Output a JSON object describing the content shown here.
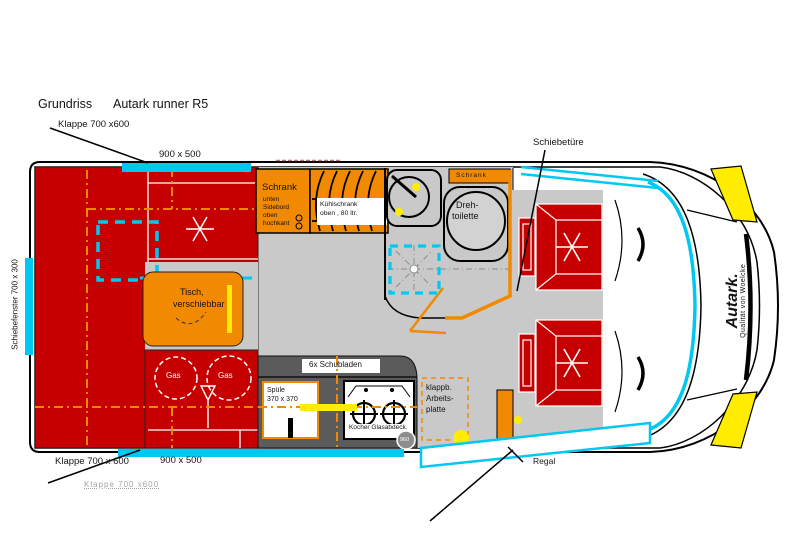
{
  "header": {
    "title": "Grundriss",
    "model": "Autark runner R5"
  },
  "exterior": {
    "top_hatch": "Klappe 700 x600",
    "top_window": "900 x 500",
    "side_window": "Schiebefenster 700 x 300",
    "sliding_door": "Schiebetüre",
    "bottom_hatch": "Klappe 700 x 600",
    "bottom_window": "900 x 500",
    "bottom_hatch_ghost": "Klappe 700 x600",
    "brand": "Autark.",
    "brand_sub": "Qualität von Woelcke"
  },
  "interior": {
    "wardrobe": {
      "line1": "Schrank",
      "line2": "unten",
      "line3": "Sidebord",
      "line4": "oben",
      "line5": "hochkant"
    },
    "fridge": {
      "line1": "Kühlschrank",
      "line2": "oben , 80 ltr."
    },
    "bath_cabinet": "Schrank",
    "toilet": {
      "line1": "Dreh-",
      "line2": "toilette"
    },
    "table": {
      "line1": "Tisch,",
      "line2": "verschiebbar"
    },
    "gas1": "Gas",
    "gas2": "Gas",
    "drawers": "6x Schubladen",
    "sink": {
      "line1": "Spüle",
      "line2": "370 x 370"
    },
    "cooker": "Kocher Glasabdeck.",
    "dim_circle": "960",
    "worktop": {
      "line1": "klappb.",
      "line2": "Arbeits-",
      "line3": "platte"
    },
    "shelf": "Regal"
  },
  "colors": {
    "red": "#C60000",
    "orange": "#F18A00",
    "cyan": "#00C8F2",
    "yellow": "#FFEC00",
    "floor": "#C9C9C9",
    "counter": "#5B5B5B"
  }
}
